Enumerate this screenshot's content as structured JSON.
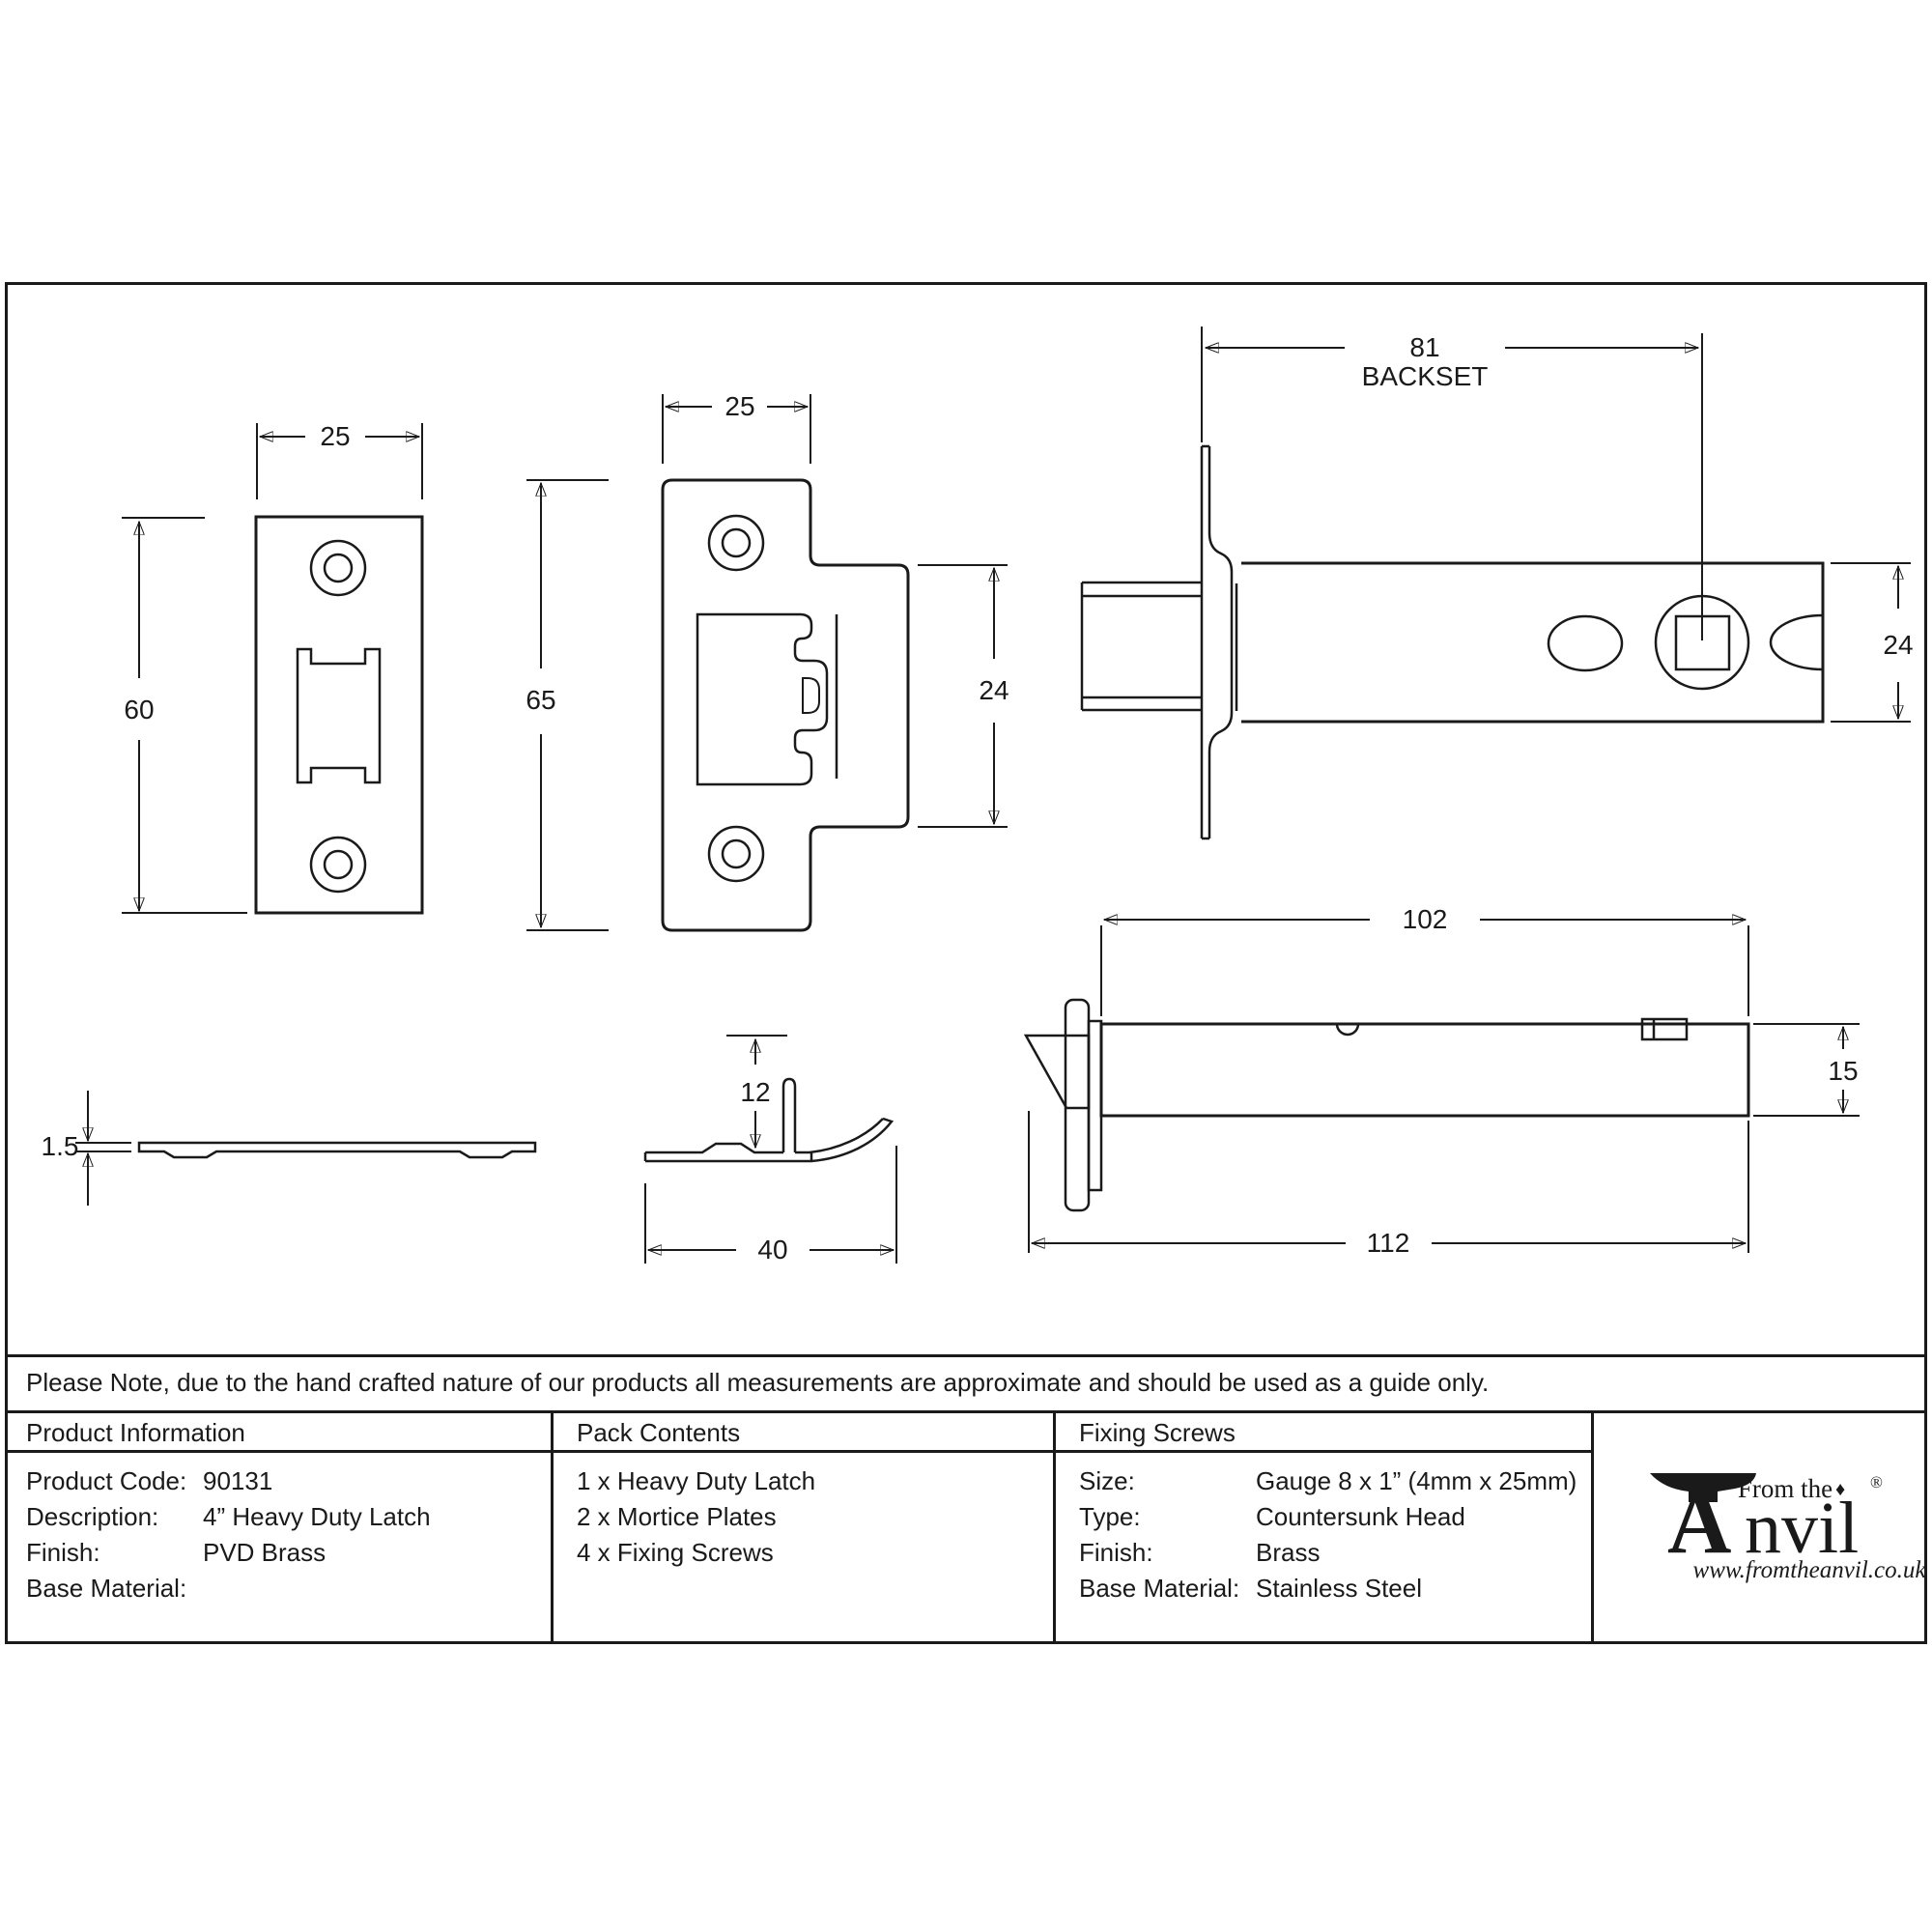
{
  "note": "Please Note, due to the hand crafted nature of our products all measurements are approximate and should be used as a guide only.",
  "table": {
    "product_information": {
      "title": "Product Information",
      "rows": [
        {
          "label": "Product Code:",
          "value": "90131"
        },
        {
          "label": "Description:",
          "value": "4” Heavy Duty Latch"
        },
        {
          "label": "Finish:",
          "value": "PVD Brass"
        },
        {
          "label": "Base Material:",
          "value": ""
        }
      ]
    },
    "pack_contents": {
      "title": "Pack Contents",
      "items": [
        "1 x Heavy Duty Latch",
        "2 x Mortice Plates",
        "4 x Fixing Screws"
      ]
    },
    "fixing_screws": {
      "title": "Fixing Screws",
      "rows": [
        {
          "label": "Size:",
          "value": "Gauge 8 x 1” (4mm x 25mm)"
        },
        {
          "label": "Type:",
          "value": "Countersunk Head"
        },
        {
          "label": "Finish:",
          "value": "Brass"
        },
        {
          "label": "Base Material:",
          "value": "Stainless Steel"
        }
      ]
    }
  },
  "logo": {
    "from_the": "From the",
    "anvil_a": "A",
    "anvil_rest": "nvil",
    "diamond": "♦",
    "registered": "®",
    "url": "www.fromtheanvil.co.uk"
  },
  "dims": {
    "plate1_width": "25",
    "plate1_height": "60",
    "plate2_width": "25",
    "plate2_height": "65",
    "plate2_tab_height": "24",
    "backset": "81",
    "backset_label": "BACKSET",
    "latch_body_height": "24",
    "plate_thickness": "1.5",
    "spring_plate_length": "40",
    "spring_tab_height": "12",
    "tube_length": "102",
    "tube_height": "15",
    "overall_length": "112"
  }
}
